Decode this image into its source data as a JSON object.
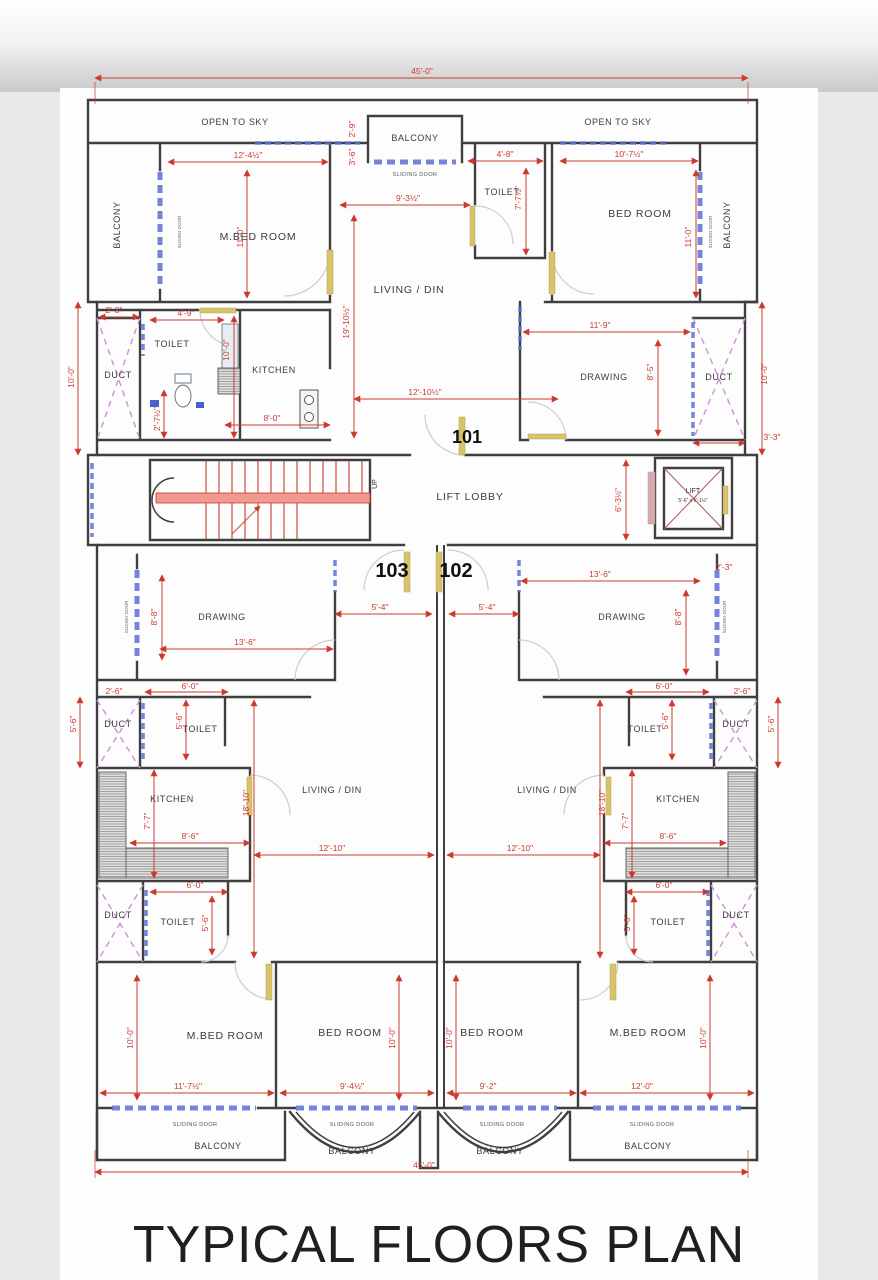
{
  "title": "TYPICAL FLOORS PLAN",
  "units": {
    "u101": "101",
    "u102": "102",
    "u103": "103"
  },
  "rooms": {
    "open_to_sky": "OPEN TO SKY",
    "balcony": "BALCONY",
    "sliding_door": "SLIDING DOOR",
    "m_bed": "M.BED ROOM",
    "bed": "BED ROOM",
    "toilet": "TOILET",
    "living": "LIVING / DIN",
    "drawing": "DRAWING",
    "kitchen": "KITCHEN",
    "duct": "DUCT",
    "lift_lobby": "LIFT LOBBY",
    "lift": "LIFT",
    "lift_size": "5'-6\" x 6'-1½\"",
    "up": "UP"
  },
  "dims": {
    "d45": "45'-0\"",
    "d2_9": "2'-9\"",
    "d3_6": "3'-6\"",
    "d12_4": "12'-4½\"",
    "d11_0": "11'-0\"",
    "d9_3": "9'-3½\"",
    "d4_8": "4'-8\"",
    "d7_7h": "7'-7½\"",
    "d10_7": "10'-7½\"",
    "d19_10": "19'-10½\"",
    "d12_10h": "12'-10½\"",
    "d4_9": "4'-9\"",
    "d2_3": "2'-3\"",
    "d10_0": "10'-0\"",
    "d2_7": "2'-7½\"",
    "d8_0": "8'-0\"",
    "d11_9": "11'-9\"",
    "d8_5": "8'-5\"",
    "d3_3": "3'-3\"",
    "d6_3": "6'-3½\"",
    "d13_6": "13'-6\"",
    "d5_4": "5'-4\"",
    "d8_8": "8'-8\"",
    "d2_6": "2'-6\"",
    "d5_6": "5'-6\"",
    "d6_0": "6'-0\"",
    "d7_7": "7'-7\"",
    "d8_6": "8'-6\"",
    "d18_10": "18'-10\"",
    "d12_10": "12'-10\"",
    "d5_0": "5'-0\"",
    "d11_7": "11'-7½\"",
    "d9_4": "9'-4½\"",
    "d9_2": "9'-2\"",
    "d12_0": "12'-0\""
  }
}
